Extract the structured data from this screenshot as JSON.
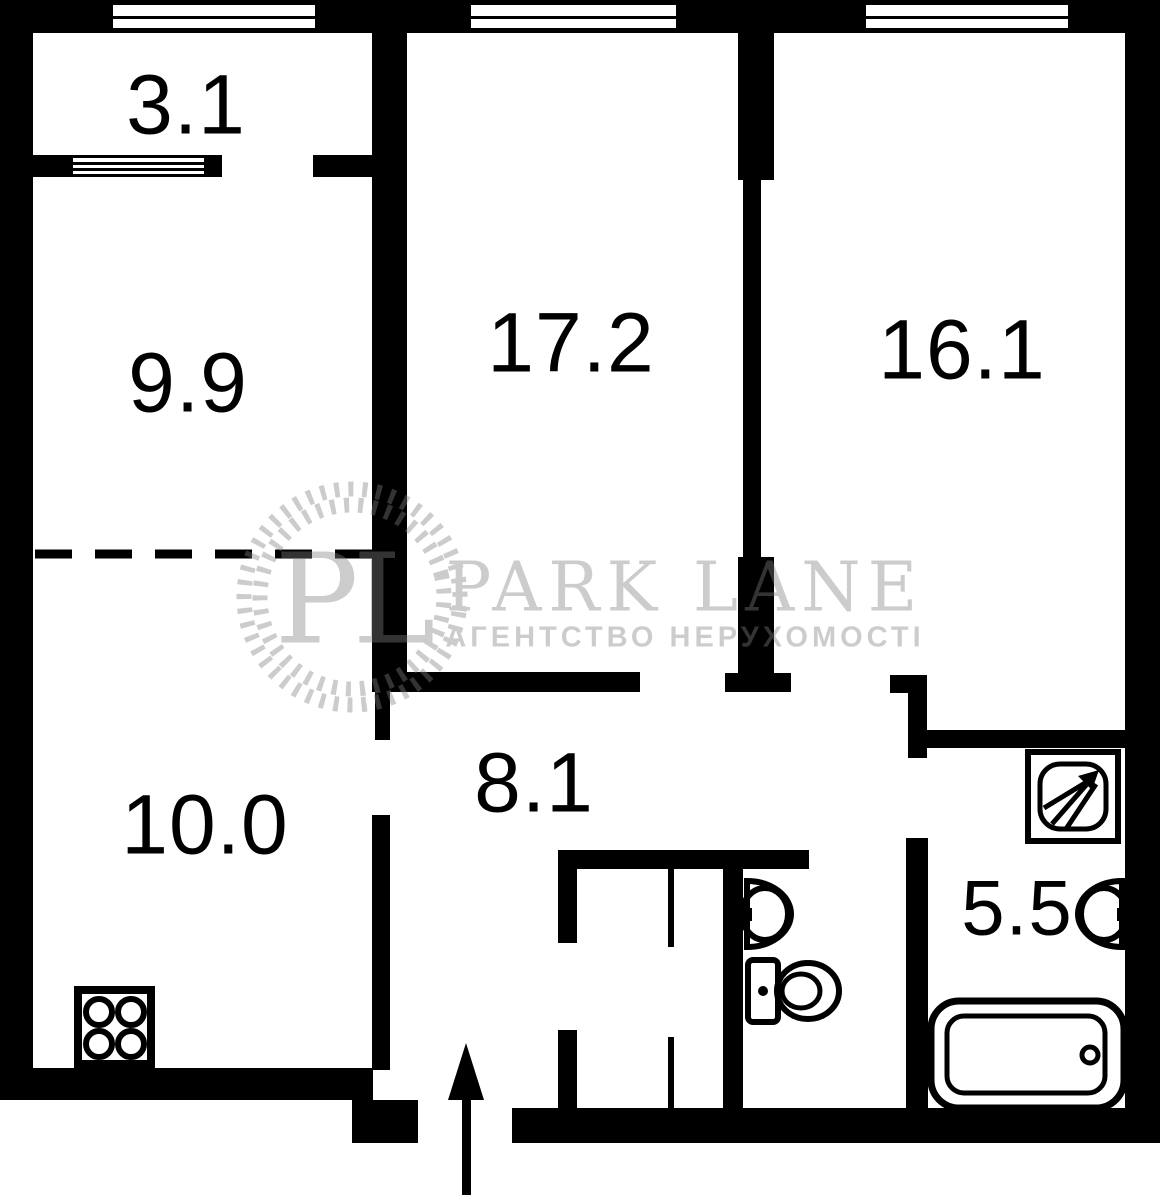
{
  "plan_title": "apartment-floor-plan",
  "rooms": {
    "balcony": "3.1",
    "room_left": "9.9",
    "room_center": "17.2",
    "room_right": "16.1",
    "kitchen": "10.0",
    "hallway": "8.1",
    "bathroom": "5.5"
  },
  "watermark": {
    "initials": "PL",
    "brand": "PARK LANE",
    "subtitle": "АГЕНТСТВО НЕРУХОМОСТІ"
  },
  "icons": {
    "window": "window-icon (white band with mullion lines in black wall)",
    "stove": "stove-icon (square with 4 burners)",
    "sink_wc": "sink-icon (half-oval on wall)",
    "toilet": "toilet-icon (tank + bowl)",
    "shower": "shower-icon (square with NE arrow spray)",
    "bathtub": "bathtub-icon (rounded tub with drain)",
    "entrance": "entrance-arrow-icon (up arrow at entry door)"
  },
  "colors": {
    "wall": "#000000",
    "background": "#ffffff",
    "watermark_blend": "#333333"
  }
}
